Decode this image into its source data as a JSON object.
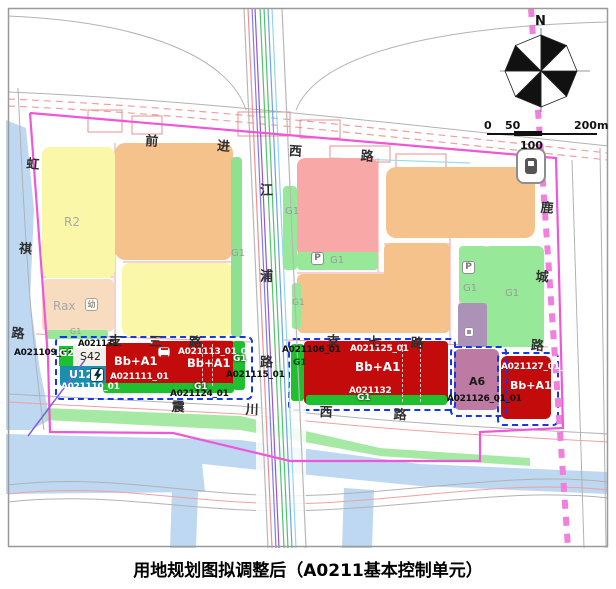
{
  "title": "用地规划图拟调整后（A0211基本控制单元）",
  "compass": {
    "north_label": "N"
  },
  "scale_bar": {
    "tick_0": "0",
    "tick_50": "50",
    "tick_100": "100",
    "tick_200": "200m"
  },
  "roads": {
    "qianjin_west": "前进西路",
    "zhisan": "支三路",
    "zhiqi": "支七路",
    "zhenchuan_west": "震川西路",
    "hongqi": "虹祺路",
    "jiangpu": "江浦路",
    "lucheng": "鹿城路"
  },
  "land_use_labels": {
    "r2": "R2",
    "rax": "Rax",
    "g1": "G1",
    "g2": "G2",
    "s42": "S42",
    "u12": "U12",
    "a6": "A6",
    "bb_a1": "Bb+A1",
    "parking": "P",
    "kindergarten": "幼"
  },
  "parcel_codes": {
    "a021106": "A021106_01",
    "a021109": "A021109_01",
    "a021110": "A021110_01",
    "a021111": "A021111_01",
    "a021113": "A021113_01_01",
    "a021115": "A021115_01",
    "a021124": "A021124_01",
    "a021125": "A021125_01",
    "a021126": "A021126_01_01",
    "a021127": "A021127_01_01",
    "a021131": "A021131",
    "a021132": "A021132"
  },
  "colors": {
    "residential_yellow": "#fbf7a8",
    "orange": "#f6c28b",
    "pink": "#f9a8a8",
    "green_light": "#98e899",
    "green_bright": "#1fc02f",
    "red": "#c30b0b",
    "teal_u12": "#1a8fae",
    "mauve_a6": "#bd7ba3",
    "purple_muted": "#ab92b6",
    "water": "#bdd8f0",
    "boundary_magenta": "#f057d8",
    "metro_pink": "#f07fdd",
    "cluster_dashed_blue": "#1537ec"
  }
}
